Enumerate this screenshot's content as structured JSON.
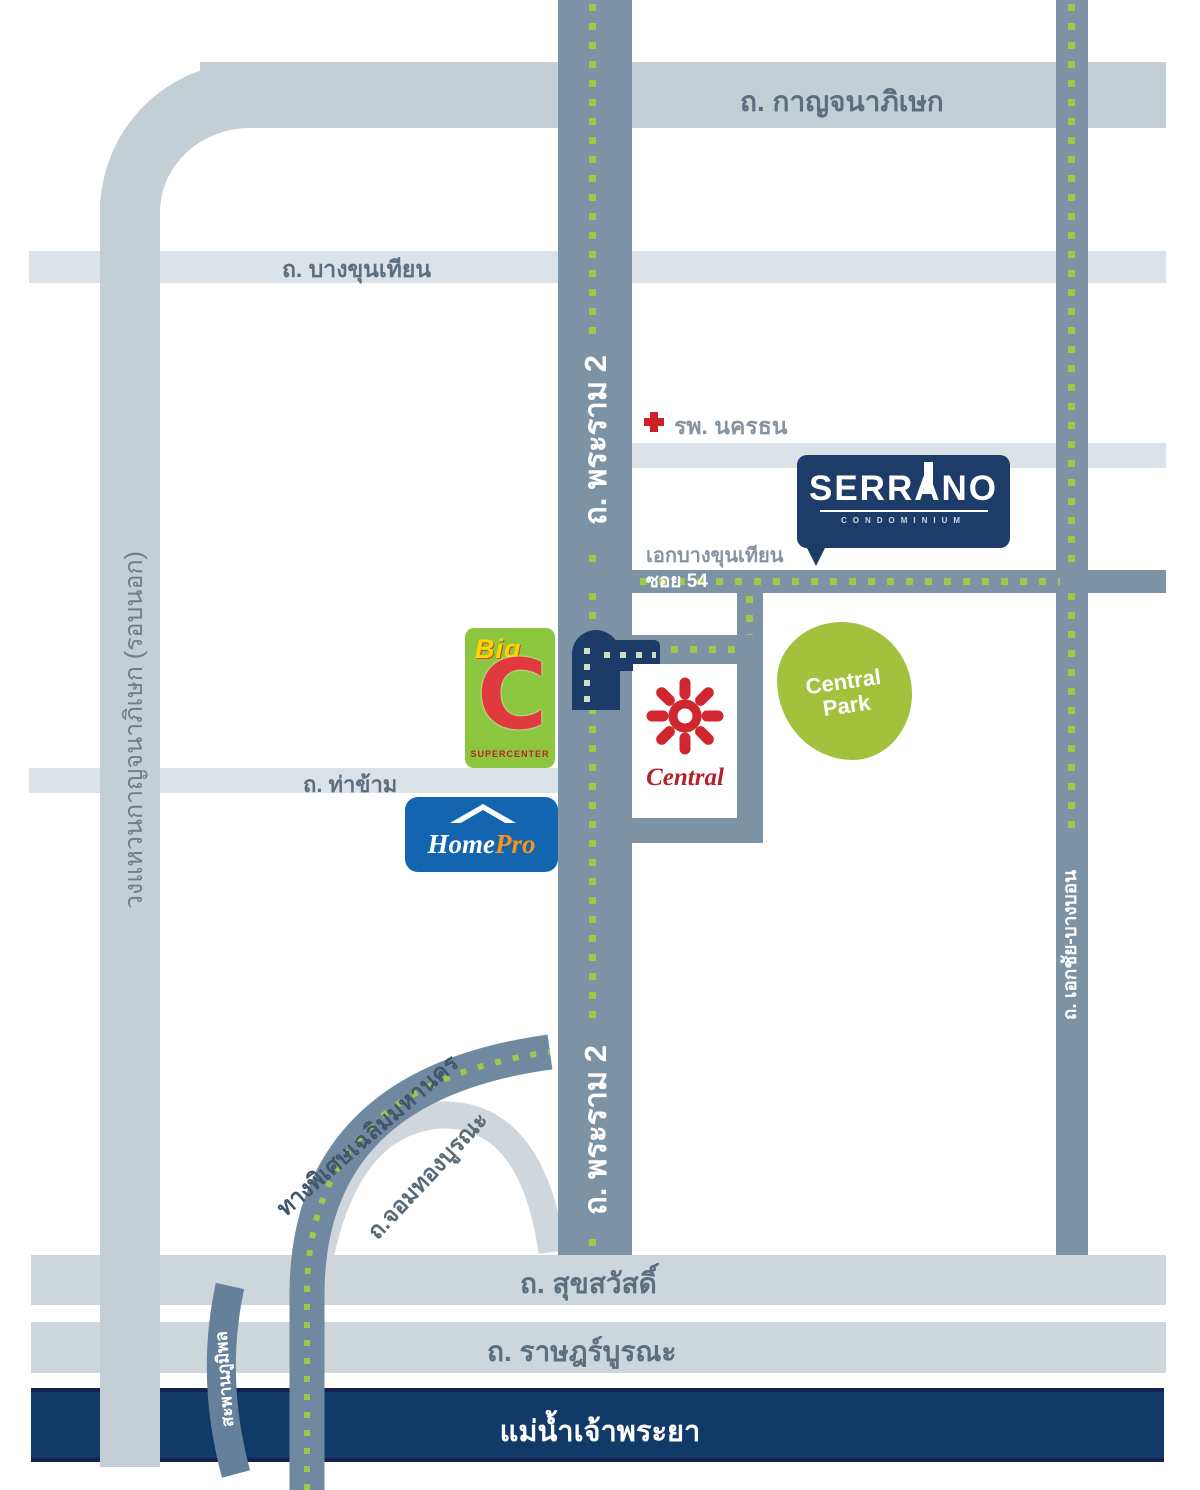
{
  "roads": {
    "kanchanaphisek": "ถ. กาญจนาภิเษก",
    "bang_khun_thian": "ถ. บางขุนเทียน",
    "rama2": "ถ. พระราม 2",
    "ekkachai_bangbon": "ถ. เอกชัย-บางบอน",
    "outer_ring": "วงแหวนกาญจนาภิเษก (รอบนอก)",
    "tha_kham": "ถ. ท่าข้าม",
    "soi54": "ซอย 54",
    "ek_bang_khun_thian": "เอกบางขุนเทียน",
    "suksawat": "ถ. สุขสวัสดิ์",
    "ratburana": "ถ. ราษฎร์บูรณะ",
    "expressway": "ทางพิเศษเฉลิมมหานคร",
    "chom_thong_burana": "ถ.จอมทองบูรณะ",
    "bhumibol_bridge": "สะพานภูมิพล",
    "chao_phraya_river": "แม่น้ำเจ้าพระยา"
  },
  "places": {
    "hospital": "รพ. นครธน",
    "serrano": {
      "name": "SERRANO",
      "subtitle": "CONDOMINIUM"
    },
    "big_c": {
      "top": "Big",
      "letter": "C",
      "bottom": "SUPERCENTER"
    },
    "central": "Central",
    "central_park": "Central Park",
    "homepro": {
      "home": "Home",
      "pro": "Pro"
    }
  },
  "colors": {
    "main_road": "#7b93a5",
    "light_road": "#dce3e8",
    "boulevard": "#ccd6db",
    "ring_road": "#c3ced5",
    "navy": "#1e3c69",
    "river_fill": "#123a69",
    "route_dot_green": "#9ec848",
    "brand_red": "#cc2229",
    "bigc_green": "#8cc63e",
    "central_park_green": "#a3c13c",
    "homepro_blue": "#1465b0",
    "homepro_orange": "#f7941d"
  }
}
